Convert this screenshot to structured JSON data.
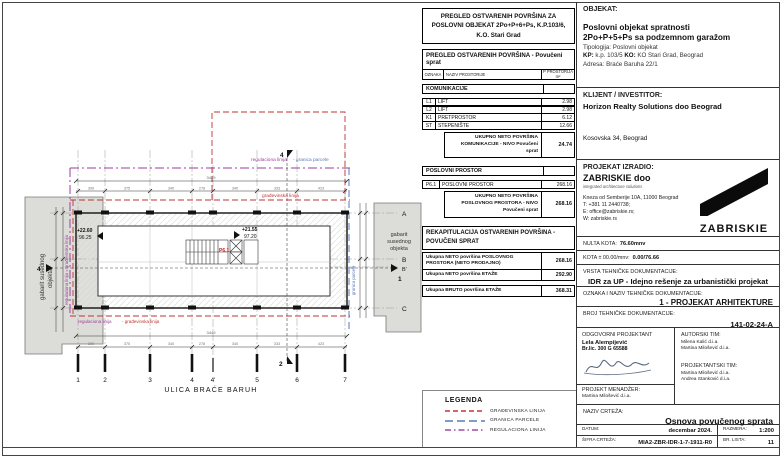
{
  "area_table": {
    "title": "PREGLED OSTVARENIH POVRŠINA ZA POSLOVNI OBJEKAT 2Po+P+6+Ps, K.P.103/6, K.O. Stari Grad",
    "subtitle": "PREGLED OSTVARENIH POVRŠINA - Povučeni sprat",
    "col_oznaka": "OZNAKA",
    "col_naziv": "NAZIV PROSTORIJE",
    "col_p": "P PROSTORIJA m²",
    "sec1": "KOMUNIKACIJE",
    "rows1": [
      {
        "code": "L1",
        "name": "LIFT",
        "val": "2.98"
      },
      {
        "code": "L2",
        "name": "LIFT",
        "val": "2.98"
      },
      {
        "code": "K1",
        "name": "PRETPROSTOR",
        "val": "6.12"
      },
      {
        "code": "ST",
        "name": "STEPENIŠTE",
        "val": "12.66"
      }
    ],
    "sum1_label": "UKUPNO NETO POVRŠINA KOMUNIKACIJE - NIVO Povučeni sprat",
    "sum1_val": "24.74",
    "sec2": "POSLOVNI PROSTOR",
    "rows2": [
      {
        "code": "P6.1",
        "name": "POSLOVNI PROSTOR",
        "val": "268.16"
      }
    ],
    "sum2_label": "UKUPNO NETO POVRŠINA POSLOVNOG PROSTORA - NIVO Povučeni sprat",
    "sum2_val": "268.16",
    "rekap_title": "REKAPITULACIJA OSTVARENIH POVRŠINA - POVUČENI SPRAT",
    "rekap": [
      {
        "label": "Ukupna NETO površina POSLOVNOG PROSTORA (NETO PRODAJNO)",
        "val": "268.16"
      },
      {
        "label": "Ukupna NETO površina ETAŽE",
        "val": "292.90"
      },
      {
        "label": "Ukupna BRUTO površina ETAŽE",
        "val": "368.31"
      }
    ]
  },
  "legend": {
    "title": "LEGENDA",
    "items": [
      {
        "label": "GRAĐEVINSKA LINIJA",
        "color": "#cc3333",
        "style": "dashed"
      },
      {
        "label": "GRANICA PARCELE",
        "color": "#5b79b5",
        "style": "long-dash"
      },
      {
        "label": "REGULACIONA LINIJA",
        "color": "#a04a9e",
        "style": "dash-dot"
      }
    ]
  },
  "titleblock": {
    "objekat_label": "OBJEKAT:",
    "objekat_line1": "Poslovni objekat spratnosti",
    "objekat_line2": "2Po+P+5+Ps sa podzemnom garažom",
    "tipologija_label": "Tipologija:",
    "tipologija_value": "Poslovni objekat",
    "kp_label": "KP:",
    "kp_value": "k.p. 103/5",
    "ko_label": "KO:",
    "ko_value": "KO Stari Grad, Beograd",
    "adresa_label": "Adresa:",
    "adresa_value": "Braće Baruha 22/1",
    "klijent_label": "KLIJENT / INVESTITOR:",
    "klijent_name": "Horizon Realty Solutions doo Beograd",
    "klijent_addr": "Kosovska 34, Beograd",
    "izradio_label": "PROJEKAT IZRADIO:",
    "firm_name": "ZABRISKIE doo",
    "firm_tagline": "integrated architecture solutions",
    "firm_addr": "Kneza od Semberije 10A, 11000 Beograd",
    "firm_tel": "T: +381 11 2440738;",
    "firm_email": "E: office@zabriskie.rs;",
    "firm_web": "W: zabriskie.rs",
    "logo_text": "ZABRISKIE",
    "nulta_label": "NULTA KOTA:",
    "nulta_value": "76.60mnv",
    "kota_label": "KOTA ± 00.00/mnv:",
    "kota_value": "0.00/76.66",
    "vrsta_label": "VRSTA TEHNIČKE DOKUMENTACIJE:",
    "vrsta_value": "IDR za UP - Idejno rešenje za urbanistički projekat",
    "oznaka_label": "OZNAKA I NAZIV TEHNIČKE DOKUMENTACIJE:",
    "oznaka_value": "1 - PROJEKAT ARHITEKTURE",
    "broj_label": "BROJ TEHNIČKE DOKUMENTACIJE:",
    "broj_value": "141-02-24-A",
    "odgovorni_label": "ODGOVORNI PROJEKTANT",
    "odgovorni_name": "Lela Alempijević",
    "odgovorni_lic": "Br.lic. 300 G 65588",
    "autorski_label": "AUTORSKI TIM:",
    "autorski_1": "Milena Kalić d.i.a.",
    "autorski_2": "Martina Milošević d.i.a.",
    "projektantski_label": "PROJEKTANTSKI TIM:",
    "projektantski_1": "Martina Milošević d.i.a.",
    "projektantski_2": "Andrea Stanković d.i.a.",
    "menadzer_label": "PROJEKT MENADŽER:",
    "menadzer_name": "Martina Milošević d.i.a.",
    "naziv_label": "NAZIV CRTEŽA:",
    "naziv_value": "Osnova povučenog sprata",
    "datum_label": "DATUM:",
    "datum_value": "decembar 2024.",
    "razmera_label": "RAZMERA:",
    "razmera_value": "1:200",
    "sifra_label": "ŠIFRA CRTEŽA:",
    "sifra_value": "MIA2-ZBR-IDR-1-7-1911-R0",
    "lista_label": "BR. LISTA:",
    "lista_value": "11"
  },
  "plan": {
    "street": "ULICA BRAĆE BARUH",
    "axes_numbers": [
      "1",
      "2",
      "3",
      "4",
      "4'",
      "5",
      "6",
      "7"
    ],
    "axes_letters": [
      "A",
      "B",
      "B'",
      "C"
    ],
    "reg_label_1": "regulaciona linija",
    "reg_label_2": "- granica parcele",
    "grad_label": "građevinska linija",
    "bottom_label_1": "regulaciona linija",
    "bottom_label_2": "- građevinska linija",
    "left_vertical_label": "regulaciona linija = građevinska linija",
    "right_vertical_label": "granica parcele",
    "neighbor_left_1": "gabarit susednog",
    "neighbor_left_2": "objekta",
    "neighbor_right": [
      "gabarit",
      "susednog",
      "objekta"
    ],
    "elev_a_top": "+22.60",
    "elev_a_bot": "96.25",
    "elev_b_top": "+21.55",
    "elev_b_bot": "97.20",
    "room_tag": "P6.1",
    "marker_top": "4",
    "marker_bottom": "2",
    "marker_left": "4",
    "marker_right": "1",
    "dim_total": "3449",
    "dims": [
      "399",
      "375",
      "340",
      "278",
      "340",
      "333",
      "423"
    ]
  }
}
